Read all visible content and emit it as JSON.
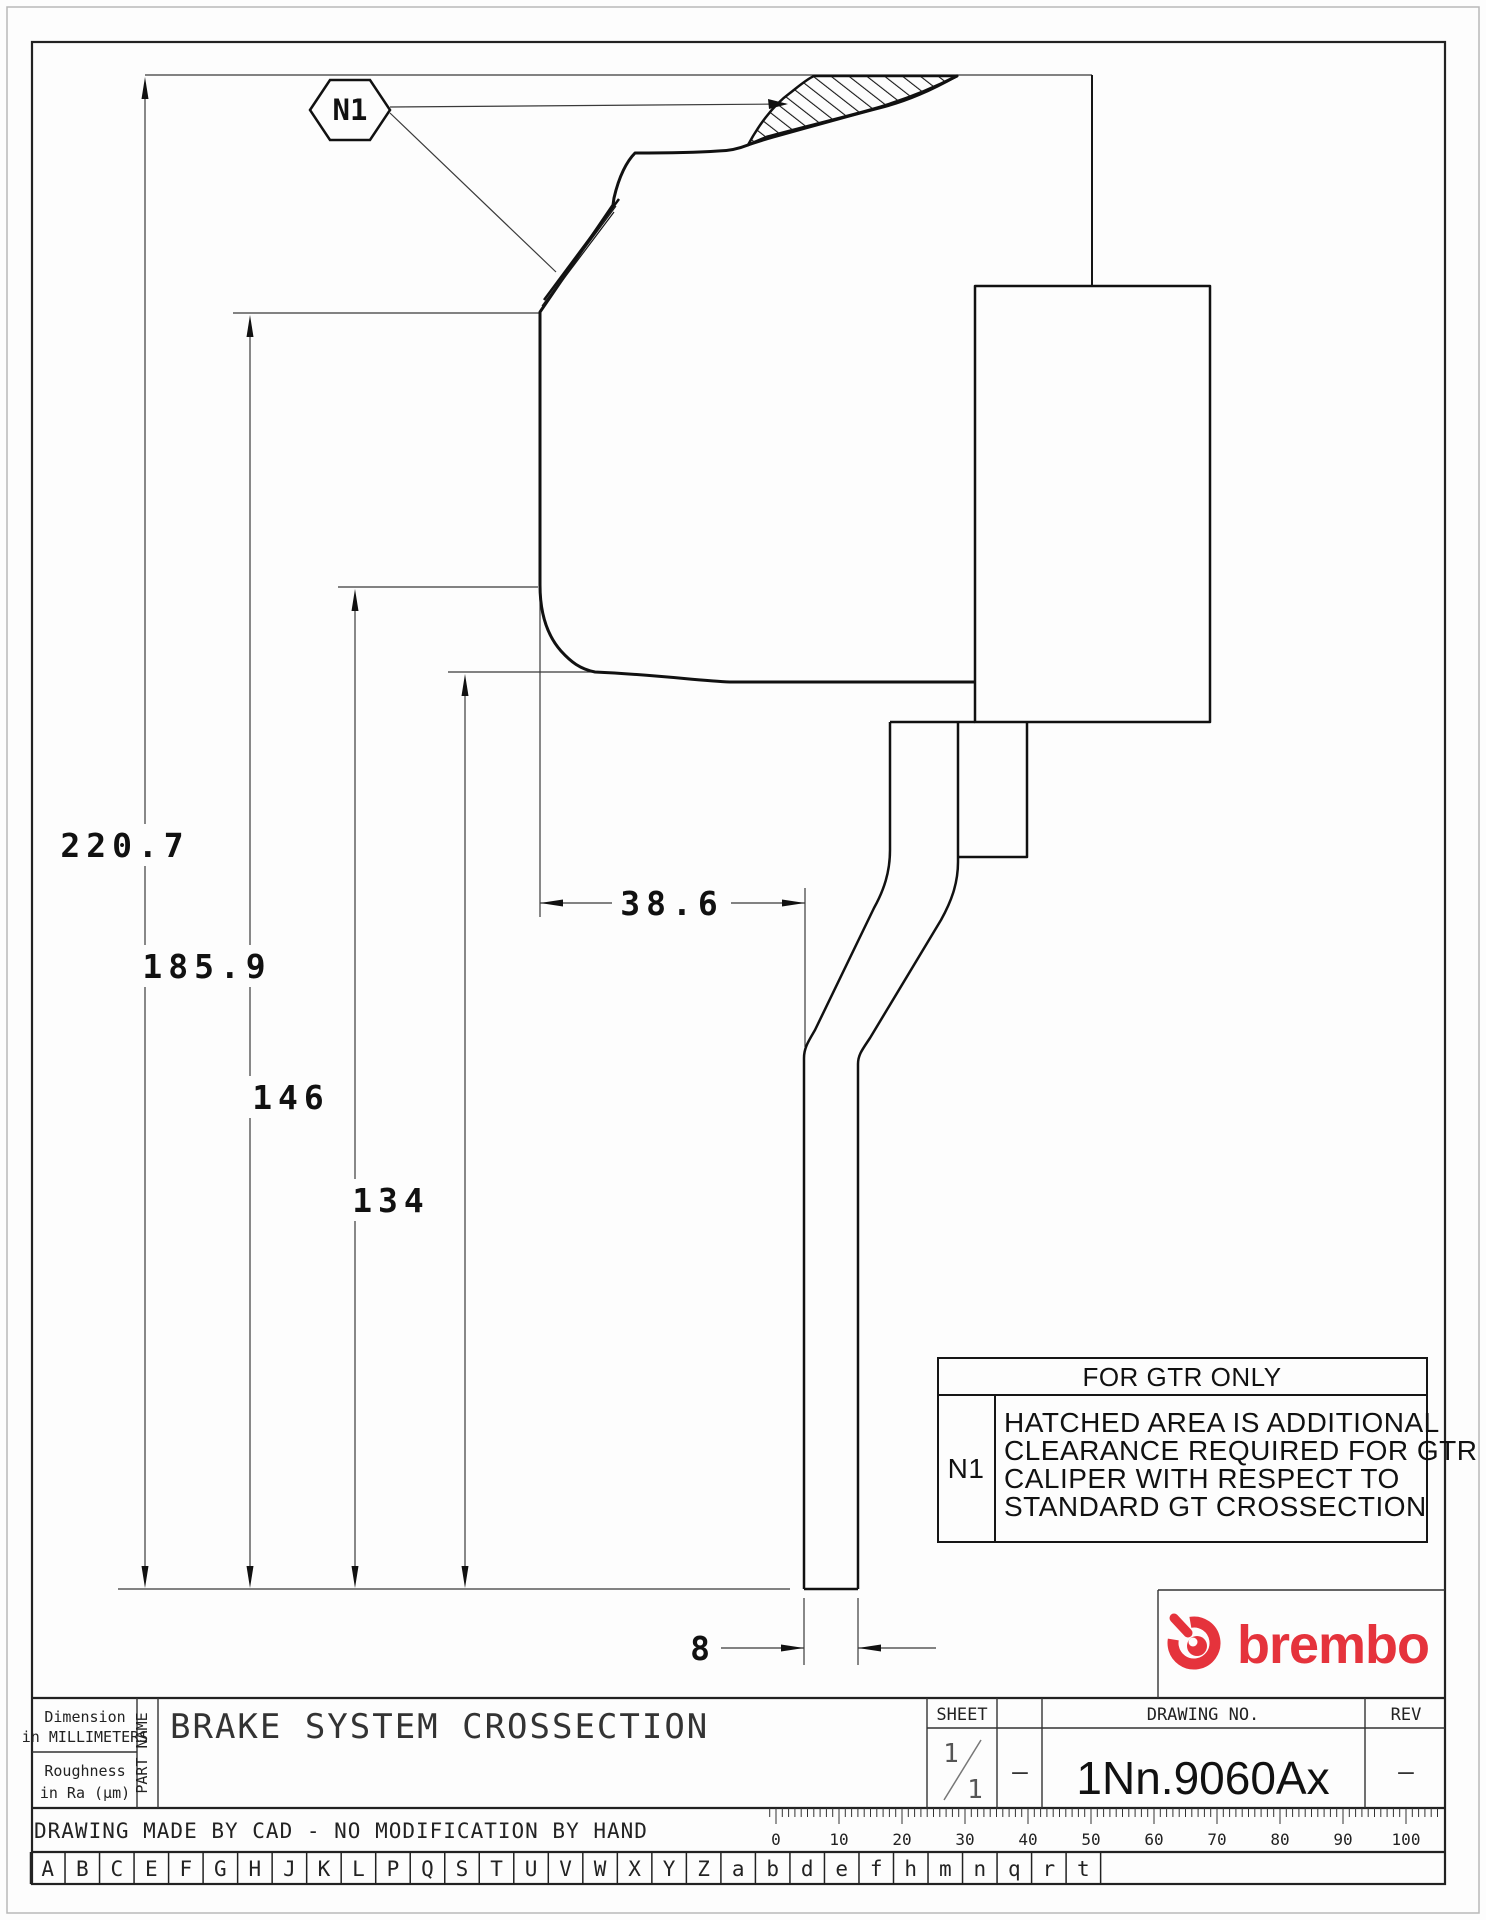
{
  "drawing": {
    "dims": {
      "h220": "220.7",
      "h185": "185.9",
      "h146": "146",
      "h134": "134",
      "w38": "38.6",
      "w8": "8"
    },
    "callout_label": "N1",
    "note": {
      "header": "FOR GTR ONLY",
      "ref": "N1",
      "lines": [
        "HATCHED AREA IS ADDITIONAL",
        "CLEARANCE REQUIRED FOR GTR",
        "CALIPER WITH RESPECT TO",
        "STANDARD GT CROSSECTION"
      ]
    }
  },
  "brand": {
    "wordmark": "brembo",
    "color": "#e5333c"
  },
  "title_block": {
    "dimension_note_line1": "Dimension",
    "dimension_note_line2": "in MILLIMETERS",
    "roughness_line1": "Roughness",
    "roughness_line2": "in Ra (μm)",
    "part_name_label": "PART NAME",
    "part_name": "BRAKE SYSTEM CROSSECTION",
    "sheet_label": "SHEET",
    "sheet_numerator": "1",
    "sheet_denominator": "1",
    "sheet_dash": "–",
    "drawing_no_label": "DRAWING NO.",
    "drawing_no": "1Nn.9060Ax",
    "rev_label": "REV",
    "rev_value": "–",
    "footer_note": "DRAWING MADE BY CAD - NO MODIFICATION BY HAND"
  },
  "ruler": {
    "labels": [
      "0",
      "10",
      "20",
      "30",
      "40",
      "50",
      "60",
      "70",
      "80",
      "90",
      "100"
    ],
    "origin_x": 776,
    "px_per_unit": 6.3
  },
  "letter_row": [
    "A",
    "B",
    "C",
    "E",
    "F",
    "G",
    "H",
    "J",
    "K",
    "L",
    "P",
    "Q",
    "S",
    "T",
    "U",
    "V",
    "W",
    "X",
    "Y",
    "Z",
    "a",
    "b",
    "d",
    "e",
    "f",
    "h",
    "m",
    "n",
    "q",
    "r",
    "t"
  ]
}
